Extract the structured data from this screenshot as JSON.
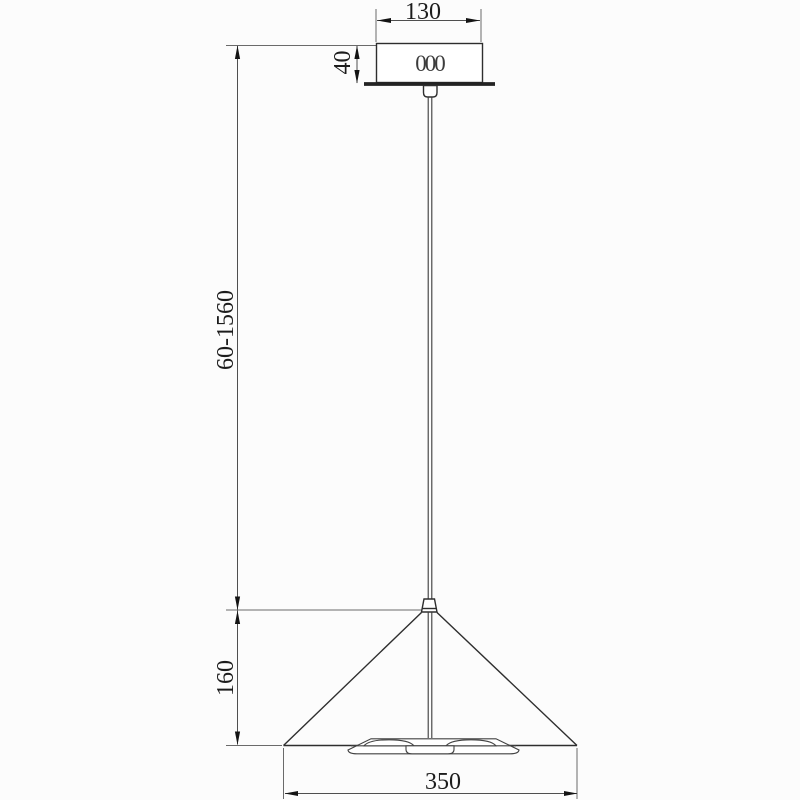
{
  "page": {
    "background": "#fcfcfc",
    "description": "Technical dimensional line drawing of a cone pendant ceiling lamp, side view"
  },
  "drawing": {
    "kind": "dimension-diagram",
    "object": "cone pendant lamp",
    "colors": {
      "object_line": "#2e2e2e",
      "dimension_line": "#4f4f4f",
      "extension_line": "#6a6a6a",
      "text": "#1c1c1c",
      "background": "#fcfcfc"
    },
    "dimensions": {
      "canopy_width": "130",
      "canopy_height": "40",
      "suspension_length_range": "60-1560",
      "shade_height": "160",
      "shade_diameter": "350"
    },
    "canopy_marking": "000"
  }
}
